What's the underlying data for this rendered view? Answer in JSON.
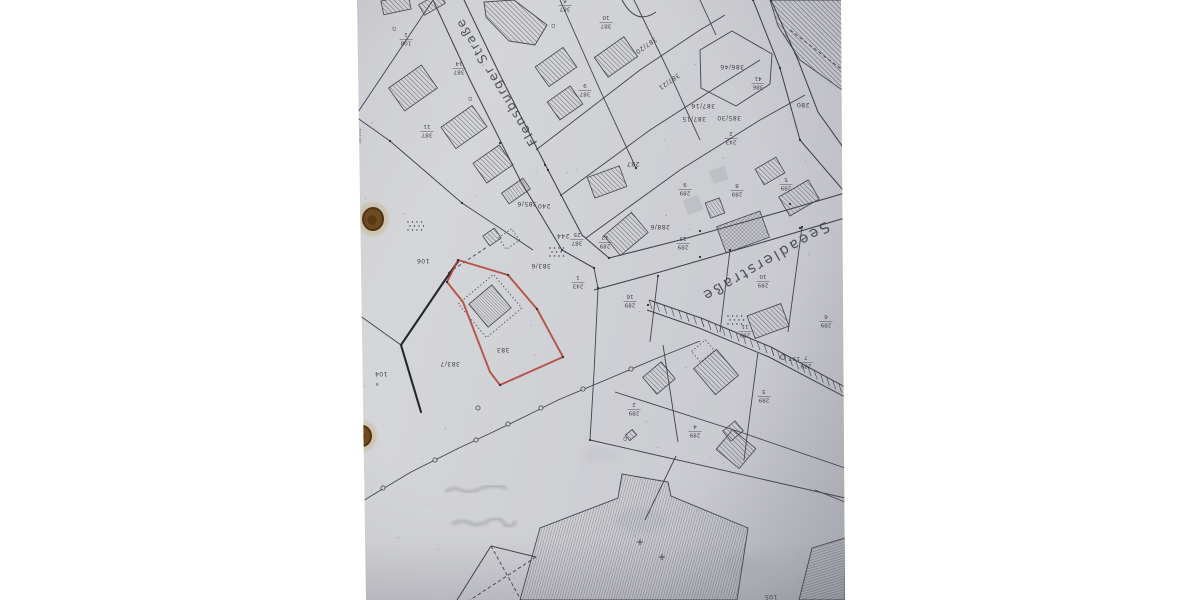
{
  "meta": {
    "description_title": "Cadastral map photo (upside-down)",
    "orientation": "rotated-180"
  },
  "colors": {
    "matte": "#ffffff",
    "paper": "#cfd0d4",
    "line": "#41414b",
    "thick_line": "#26262e",
    "red_outline": "#b2463c",
    "hatch": "#4c4c56",
    "label_text": "#2f2f38",
    "hole_brown": "#6f4a1d",
    "hole_dark": "#503413",
    "stain": "#c9b483",
    "pencil": "#989aa2"
  },
  "streets": [
    {
      "name": "Flensburger Straße"
    },
    {
      "name": "Seeadlerstraße"
    }
  ],
  "edge_label": {
    "text": "18/101",
    "x": 361,
    "y": 136
  },
  "point_marker": {
    "text": "197",
    "x": 794,
    "y": 357,
    "cx": 783,
    "cy": 357
  },
  "parcel_labels": [
    {
      "text": "287",
      "x": 633,
      "y": 162
    },
    {
      "text": "288/6",
      "x": 660,
      "y": 225
    },
    {
      "text": "386/46",
      "x": 732,
      "y": 65
    },
    {
      "text": "385/30",
      "x": 729,
      "y": 116
    },
    {
      "text": "387/16",
      "x": 703,
      "y": 104
    },
    {
      "text": "387/15",
      "x": 694,
      "y": 117
    },
    {
      "text": "387/21",
      "x": 668,
      "y": 80,
      "tilt": -35
    },
    {
      "text": "387/20",
      "x": 645,
      "y": 44,
      "tilt": -35
    },
    {
      "text": "280",
      "x": 803,
      "y": 103
    },
    {
      "text": "240",
      "x": 544,
      "y": 204
    },
    {
      "text": "244",
      "x": 563,
      "y": 234
    },
    {
      "text": "106",
      "x": 423,
      "y": 259
    },
    {
      "text": "104",
      "x": 381,
      "y": 372
    },
    {
      "text": "105",
      "x": 771,
      "y": 595
    },
    {
      "text": "383",
      "x": 503,
      "y": 348
    },
    {
      "text": "383/7",
      "x": 450,
      "y": 362
    },
    {
      "text": "383/6",
      "x": 541,
      "y": 264
    },
    {
      "text": "385/6",
      "x": 527,
      "y": 202
    }
  ],
  "stacked_labels": [
    {
      "num": "108",
      "den": "1",
      "x": 406,
      "y": 40
    },
    {
      "num": "387",
      "den": "14",
      "x": 459,
      "y": 69
    },
    {
      "num": "387",
      "den": "11",
      "x": 427,
      "y": 132
    },
    {
      "num": "387",
      "den": "8",
      "x": 565,
      "y": 6
    },
    {
      "num": "387",
      "den": "10",
      "x": 606,
      "y": 23
    },
    {
      "num": "387",
      "den": "9",
      "x": 585,
      "y": 91
    },
    {
      "num": "386",
      "den": "41",
      "x": 758,
      "y": 84
    },
    {
      "num": "243",
      "den": "2",
      "x": 731,
      "y": 139
    },
    {
      "num": "243",
      "den": "1",
      "x": 578,
      "y": 283
    },
    {
      "num": "387",
      "den": "25",
      "x": 577,
      "y": 240
    },
    {
      "num": "289",
      "den": "12",
      "x": 605,
      "y": 243
    },
    {
      "num": "289",
      "den": "13",
      "x": 683,
      "y": 244
    },
    {
      "num": "289",
      "den": "9",
      "x": 685,
      "y": 190
    },
    {
      "num": "289",
      "den": "8",
      "x": 737,
      "y": 191
    },
    {
      "num": "289",
      "den": "5",
      "x": 786,
      "y": 185
    },
    {
      "num": "289",
      "den": "10",
      "x": 763,
      "y": 282
    },
    {
      "num": "289",
      "den": "16",
      "x": 630,
      "y": 302
    },
    {
      "num": "289",
      "den": "11",
      "x": 745,
      "y": 332
    },
    {
      "num": "289",
      "den": "7",
      "x": 806,
      "y": 363
    },
    {
      "num": "289",
      "den": "6",
      "x": 826,
      "y": 322
    },
    {
      "num": "289",
      "den": "3",
      "x": 764,
      "y": 397
    },
    {
      "num": "289",
      "den": "4",
      "x": 695,
      "y": 432
    },
    {
      "num": "289",
      "den": "2",
      "x": 634,
      "y": 410
    }
  ],
  "symbols": [
    {
      "glyph": "Ω",
      "x": 394,
      "y": 27
    },
    {
      "glyph": "Ω",
      "x": 470,
      "y": 97
    },
    {
      "glyph": "Ω",
      "x": 553,
      "y": 24
    },
    {
      "glyph": "a",
      "x": 377,
      "y": 383
    },
    {
      "glyph": "Ω",
      "x": 625,
      "y": 437
    }
  ],
  "geometry": {
    "boundaries": [
      [
        [
          356,
          115
        ],
        [
          433,
          0
        ]
      ],
      [
        [
          356,
          117
        ],
        [
          390,
          141
        ]
      ],
      [
        [
          390,
          141
        ],
        [
          462,
          203
        ],
        [
          533,
          250
        ]
      ],
      [
        [
          356,
          313
        ],
        [
          401,
          345
        ]
      ],
      [
        [
          594,
          268
        ],
        [
          598,
          288
        ]
      ],
      [
        [
          598,
          288
        ],
        [
          594,
          373
        ],
        [
          590,
          440
        ]
      ],
      [
        [
          658,
          276
        ],
        [
          650,
          342
        ]
      ],
      [
        [
          730,
          250
        ],
        [
          720,
          332
        ]
      ],
      [
        [
          802,
          227
        ],
        [
          788,
          332
        ]
      ],
      [
        [
          590,
          440
        ],
        [
          845,
          498
        ]
      ],
      [
        [
          615,
          392
        ],
        [
          740,
          432
        ],
        [
          845,
          468
        ]
      ],
      [
        [
          663,
          345
        ],
        [
          678,
          442
        ]
      ],
      [
        [
          758,
          352
        ],
        [
          744,
          460
        ]
      ],
      [
        [
          536,
          150
        ],
        [
          640,
          70
        ],
        [
          700,
          30
        ],
        [
          725,
          15
        ]
      ],
      [
        [
          560,
          196
        ],
        [
          650,
          130
        ],
        [
          720,
          85
        ],
        [
          760,
          60
        ]
      ],
      [
        [
          586,
          238
        ],
        [
          680,
          170
        ],
        [
          760,
          120
        ],
        [
          805,
          95
        ]
      ],
      [
        [
          560,
          0
        ],
        [
          600,
          90
        ],
        [
          636,
          168
        ]
      ],
      [
        [
          634,
          0
        ],
        [
          668,
          70
        ],
        [
          700,
          140
        ]
      ],
      [
        [
          700,
          0
        ],
        [
          716,
          35
        ]
      ],
      [
        [
          815,
          490
        ],
        [
          845,
          502
        ]
      ],
      [
        [
          676,
          456
        ],
        [
          645,
          520
        ]
      ],
      [
        [
          655,
          359
        ],
        [
          700,
          341
        ]
      ]
    ],
    "dashed_lines": [
      [
        [
          448,
          273
        ],
        [
          487,
          247
        ]
      ],
      [
        [
          790,
          30
        ],
        [
          845,
          72
        ]
      ],
      [
        [
          491,
          546
        ],
        [
          521,
          600
        ]
      ],
      [
        [
          536,
          557
        ],
        [
          470,
          600
        ]
      ]
    ],
    "solid_detail_lines": [
      [
        [
          491,
          546
        ],
        [
          536,
          557
        ]
      ],
      [
        [
          491,
          546
        ],
        [
          457,
          600
        ]
      ]
    ],
    "street_lines": [
      [
        [
          433,
          0
        ],
        [
          470,
          80
        ],
        [
          520,
          180
        ],
        [
          562,
          250
        ],
        [
          594,
          268
        ]
      ],
      [
        [
          464,
          0
        ],
        [
          500,
          75
        ],
        [
          548,
          170
        ],
        [
          582,
          235
        ],
        [
          609,
          258
        ]
      ],
      [
        [
          609,
          258
        ],
        [
          680,
          240
        ],
        [
          780,
          212
        ],
        [
          845,
          193
        ]
      ],
      [
        [
          594,
          290
        ],
        [
          660,
          272
        ],
        [
          760,
          243
        ],
        [
          845,
          218
        ]
      ],
      [
        [
          753,
          0
        ],
        [
          780,
          68
        ],
        [
          800,
          140
        ],
        [
          843,
          190
        ]
      ],
      [
        [
          771,
          0
        ],
        [
          798,
          60
        ],
        [
          818,
          112
        ],
        [
          845,
          150
        ]
      ]
    ],
    "top_curve": "M 622,0 Q 636,26 656,12",
    "hexagon": [
      [
        700,
        50
      ],
      [
        732,
        31
      ],
      [
        772,
        54
      ],
      [
        770,
        84
      ],
      [
        736,
        106
      ],
      [
        701,
        88
      ]
    ],
    "thick_parcel": [
      [
        459,
        260
      ],
      [
        443,
        283
      ],
      [
        401,
        345
      ],
      [
        421,
        412
      ]
    ],
    "red_parcel": [
      [
        458,
        260
      ],
      [
        508,
        275
      ],
      [
        537,
        309
      ],
      [
        563,
        357
      ],
      [
        500,
        385
      ],
      [
        490,
        372
      ],
      [
        463,
        302
      ],
      [
        447,
        282
      ]
    ],
    "stone_line": [
      [
        356,
        505
      ],
      [
        411,
        472
      ],
      [
        459,
        448
      ],
      [
        493,
        432
      ],
      [
        524,
        417
      ],
      [
        558,
        400
      ],
      [
        608,
        379
      ],
      [
        655,
        359
      ]
    ],
    "stone_circles": [
      [
        383,
        488
      ],
      [
        435,
        460
      ],
      [
        476,
        440
      ],
      [
        508,
        424
      ],
      [
        541,
        408
      ],
      [
        583,
        389
      ],
      [
        631,
        369
      ],
      [
        478,
        408
      ]
    ],
    "track": {
      "upper": [
        [
          649,
          300
        ],
        [
          701,
          318
        ],
        [
          771,
          347
        ],
        [
          845,
          387
        ]
      ],
      "lower": [
        [
          647,
          310
        ],
        [
          699,
          328
        ],
        [
          769,
          357
        ],
        [
          845,
          397
        ]
      ]
    },
    "buildings": [
      {
        "cx": 413,
        "cy": 88,
        "w": 40,
        "h": 28,
        "rot": -35,
        "hatch": "diag"
      },
      {
        "cx": 464,
        "cy": 127,
        "w": 38,
        "h": 26,
        "rot": -35,
        "hatch": "diag"
      },
      {
        "cx": 493,
        "cy": 164,
        "w": 32,
        "h": 24,
        "rot": -35,
        "hatch": "diag"
      },
      {
        "cx": 516,
        "cy": 191,
        "w": 26,
        "h": 13,
        "rot": -35,
        "hatch": "lad"
      },
      {
        "cx": 556,
        "cy": 67,
        "w": 34,
        "h": 24,
        "rot": -35,
        "hatch": "diag"
      },
      {
        "cx": 565,
        "cy": 103,
        "w": 28,
        "h": 22,
        "rot": -35,
        "hatch": "diag"
      },
      {
        "cx": 616,
        "cy": 57,
        "w": 36,
        "h": 24,
        "rot": -35,
        "hatch": "diag"
      },
      {
        "cx": 607,
        "cy": 182,
        "w": 34,
        "h": 22,
        "rot": -20,
        "hatch": "diag"
      },
      {
        "cx": 626,
        "cy": 234,
        "w": 36,
        "h": 26,
        "rot": -40,
        "hatch": "diag"
      },
      {
        "cx": 743,
        "cy": 232,
        "w": 46,
        "h": 28,
        "rot": -20,
        "hatch": "cross"
      },
      {
        "cx": 715,
        "cy": 208,
        "w": 15,
        "h": 16,
        "rot": -20,
        "hatch": "lad"
      },
      {
        "cx": 799,
        "cy": 198,
        "w": 34,
        "h": 22,
        "rot": -30,
        "hatch": "diag"
      },
      {
        "cx": 770,
        "cy": 171,
        "w": 24,
        "h": 18,
        "rot": -30,
        "hatch": "diag"
      },
      {
        "cx": 396,
        "cy": 5,
        "w": 28,
        "h": 14,
        "rot": -12,
        "hatch": "diag"
      },
      {
        "cx": 432,
        "cy": 4,
        "w": 24,
        "h": 12,
        "rot": -30,
        "hatch": "diag"
      },
      {
        "cx": 768,
        "cy": 321,
        "w": 36,
        "h": 24,
        "rot": -20,
        "hatch": "diag"
      },
      {
        "cx": 716,
        "cy": 372,
        "w": 30,
        "h": 34,
        "rot": -40,
        "hatch": "diag"
      },
      {
        "cx": 659,
        "cy": 378,
        "w": 24,
        "h": 22,
        "rot": -40,
        "hatch": "diag"
      },
      {
        "cx": 733,
        "cy": 431,
        "w": 16,
        "h": 13,
        "rot": -40,
        "hatch": "diag"
      },
      {
        "cx": 736,
        "cy": 449,
        "w": 26,
        "h": 30,
        "rot": -50,
        "hatch": "diag"
      },
      {
        "cx": 490,
        "cy": 306,
        "w": 30,
        "h": 30,
        "rot": -40,
        "hatch": "fine"
      },
      {
        "cx": 492,
        "cy": 237,
        "w": 14,
        "h": 12,
        "rot": -35,
        "hatch": "diag"
      },
      {
        "cx": 631,
        "cy": 435,
        "w": 9,
        "h": 7,
        "rot": -40,
        "hatch": "diag"
      }
    ],
    "gray_buildings": [
      {
        "cx": 693,
        "cy": 205,
        "w": 16,
        "h": 16,
        "rot": -20
      },
      {
        "cx": 719,
        "cy": 175,
        "w": 16,
        "h": 14,
        "rot": -20
      }
    ],
    "building_polys": [
      {
        "pts": [
          [
            484,
            2
          ],
          [
            514,
            0
          ],
          [
            547,
            25
          ],
          [
            535,
            45
          ],
          [
            509,
            41
          ],
          [
            486,
            17
          ]
        ],
        "hatch": "diag"
      },
      {
        "pts": [
          [
            770,
            0
          ],
          [
            845,
            0
          ],
          [
            845,
            92
          ],
          [
            800,
            60
          ],
          [
            778,
            26
          ]
        ],
        "hatch": "diag"
      },
      {
        "pts": [
          [
            520,
            600
          ],
          [
            540,
            528
          ],
          [
            618,
            498
          ],
          [
            622,
            474
          ],
          [
            668,
            482
          ],
          [
            671,
            496
          ],
          [
            748,
            528
          ],
          [
            737,
            600
          ]
        ],
        "hatch": "vert"
      },
      {
        "pts": [
          [
            812,
            548
          ],
          [
            845,
            538
          ],
          [
            845,
            600
          ],
          [
            799,
            600
          ]
        ],
        "hatch": "horiz"
      }
    ],
    "dotted_rects": [
      {
        "cx": 490,
        "cy": 306,
        "w": 46,
        "h": 44,
        "rot": -40
      },
      {
        "cx": 509,
        "cy": 239,
        "w": 16,
        "h": 14,
        "rot": -35
      },
      {
        "cx": 703,
        "cy": 351,
        "w": 18,
        "h": 14,
        "rot": -40
      }
    ],
    "dot_clusters": [
      [
        408,
        222
      ],
      [
        550,
        248
      ],
      [
        728,
        316
      ]
    ],
    "nodes": [
      [
        500,
        143
      ],
      [
        545,
        165
      ],
      [
        562,
        250
      ],
      [
        548,
        170
      ],
      [
        594,
        268
      ],
      [
        609,
        258
      ],
      [
        700,
        231
      ],
      [
        790,
        204
      ],
      [
        700,
        257
      ],
      [
        800,
        228
      ],
      [
        780,
        68
      ],
      [
        800,
        140
      ],
      [
        458,
        260
      ],
      [
        508,
        275
      ],
      [
        537,
        309
      ],
      [
        563,
        357
      ],
      [
        500,
        385
      ],
      [
        447,
        282
      ],
      [
        401,
        345
      ],
      [
        421,
        412
      ],
      [
        443,
        283
      ],
      [
        390,
        141
      ],
      [
        462,
        203
      ],
      [
        356,
        115
      ],
      [
        356,
        313
      ],
      [
        598,
        288
      ],
      [
        658,
        276
      ],
      [
        730,
        250
      ],
      [
        802,
        227
      ],
      [
        845,
        188
      ],
      [
        845,
        215
      ],
      [
        771,
        0
      ],
      [
        753,
        0
      ],
      [
        590,
        440
      ],
      [
        636,
        168
      ],
      [
        845,
        393
      ],
      [
        648,
        305
      ]
    ],
    "plus_marks": [
      [
        640,
        542
      ],
      [
        662,
        557
      ]
    ],
    "holes": [
      {
        "cx": 373,
        "cy": 219,
        "rx": 10,
        "ry": 11
      },
      {
        "cx": 362,
        "cy": 436,
        "rx": 9,
        "ry": 10
      }
    ],
    "smudges": [
      {
        "cx": 640,
        "cy": 520,
        "rx": 25,
        "ry": 12,
        "o": 0.3
      },
      {
        "cx": 745,
        "cy": 565,
        "rx": 22,
        "ry": 10,
        "o": 0.25
      },
      {
        "cx": 600,
        "cy": 455,
        "rx": 18,
        "ry": 8,
        "o": 0.22
      }
    ],
    "scribbles": [
      "M445,492 q8,-6 16,-2 t16,0 t16,-4 t14,2",
      "M452,524 q10,-5 18,-1 t18,-2 t16,2 t12,-2"
    ]
  }
}
